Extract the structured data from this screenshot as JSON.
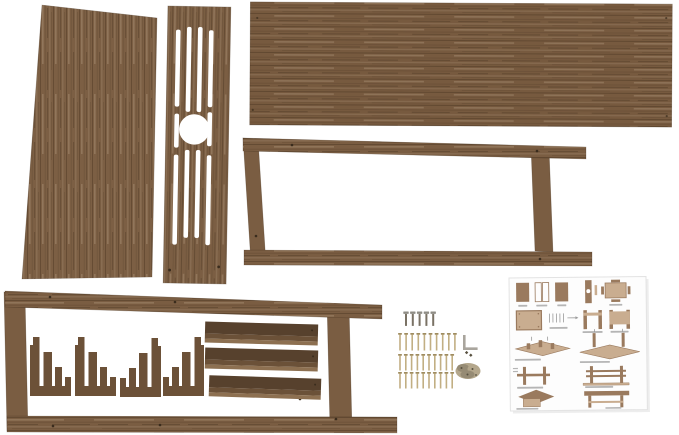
{
  "canvas": {
    "width": 679,
    "height": 435,
    "background": "#ffffff"
  },
  "colors": {
    "wood": "#7c5f44",
    "wood_top": "#775a3f",
    "wood_grille": "#7b5e43",
    "wood_frame": "#7a5d42",
    "wood_bracket": "#6c5138",
    "slat_face": "#57412d",
    "slat_mid": "#6b5138",
    "slat_edge": "#8d7051",
    "hole": "#3a2c1d",
    "bolt_head": "#8f8d86",
    "bolt_shaft": "#7a7265",
    "screw_head": "#9f8c60",
    "screw_shaft": "#c2af83",
    "allen_key": "#a9a59d",
    "metal_dark": "#57503f",
    "cluster_light": "#b4a78c",
    "cluster_mid": "#968b74",
    "page": "#fdfdfd",
    "page_shadow": "#ededed",
    "page_border": "#e3e3e3",
    "ink_wood": "#9a7a5e",
    "ink_wood_light": "#c9ad90",
    "ink_gray": "#9a9a9a",
    "ink_text": "#b5b5b5"
  },
  "hardware": {
    "bolts": {
      "count": 5,
      "x0": 406,
      "dx": 6.8,
      "y": 311.5,
      "head_w": 5.4,
      "head_h": 2.4,
      "shaft_w": 2,
      "shaft_len": 12
    },
    "screw_rows": [
      {
        "name": "long-screws",
        "count": 10,
        "x0": 400,
        "dx": 6.1,
        "y": 333,
        "len": 16
      },
      {
        "name": "medium-screws",
        "count": 10,
        "x0": 400,
        "dx": 5.8,
        "y": 354,
        "len": 15
      },
      {
        "name": "short-screws",
        "count": 10,
        "x0": 400,
        "dx": 5.8,
        "y": 372,
        "len": 15
      }
    ],
    "allen_key_count": 1
  },
  "parts": {
    "side_panel": "large wood side panel",
    "grille_panel": "slotted grille panel with round cutout",
    "tabletop_panel": "wide tabletop panel",
    "long_frame": "side frame with protruding rails",
    "base_frame": "base frame with protruding rails",
    "corner_brackets": 4,
    "support_slats": 3,
    "manual": "illustrated assembly instruction sheet"
  }
}
